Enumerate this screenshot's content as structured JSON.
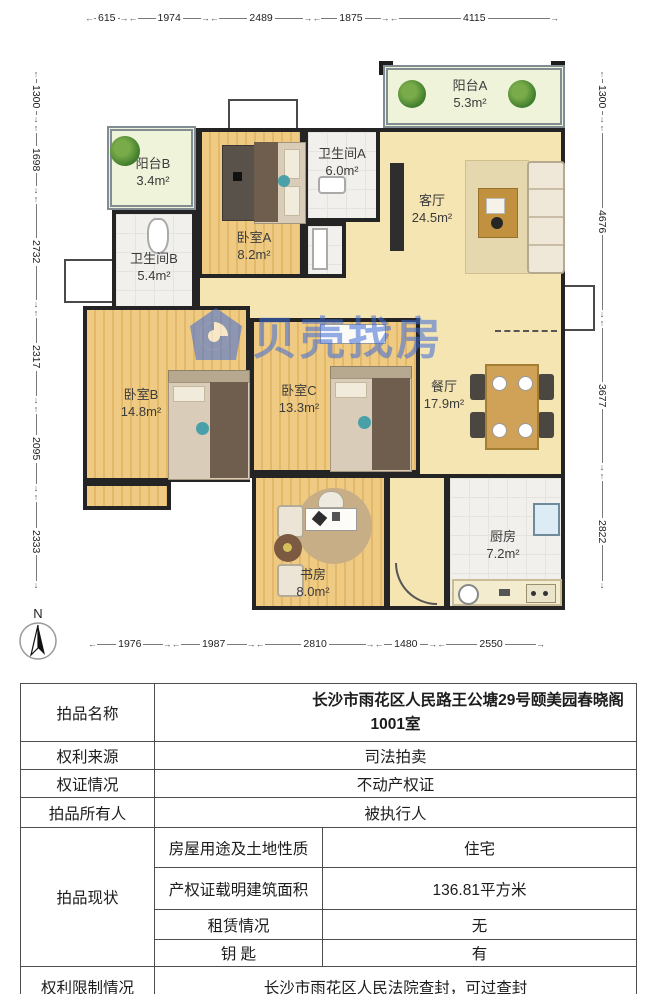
{
  "colors": {
    "accent_red": "#e8000d",
    "watermark_blue": "#3d6bd8",
    "wall": "#242424"
  },
  "floor_plan": {
    "watermark": "贝壳找房",
    "compass_label": "N",
    "dimensions": {
      "top": [
        615,
        1974,
        2489,
        1875,
        4115
      ],
      "bottom": [
        1976,
        1987,
        2810,
        1480,
        2550
      ],
      "left": [
        1300,
        1698,
        2732,
        2317,
        2095,
        2333
      ],
      "right": [
        1300,
        4676,
        3677,
        2822
      ]
    },
    "zones": [
      {
        "id": "main-floor",
        "type": "beige",
        "rect": [
          196,
          128,
          369,
          350
        ]
      },
      {
        "id": "entry-hall",
        "type": "beige",
        "rect": [
          386,
          474,
          62,
          136
        ]
      }
    ],
    "rooms": [
      {
        "id": "balcony-a",
        "name": "阳台A",
        "area": "5.3m²",
        "type": "balcony",
        "rect": [
          383,
          65,
          182,
          63
        ],
        "label": [
          470,
          95
        ]
      },
      {
        "id": "balcony-b",
        "name": "阳台B",
        "area": "3.4m²",
        "type": "balcony",
        "rect": [
          107,
          126,
          89,
          84
        ],
        "label": [
          153,
          173
        ]
      },
      {
        "id": "bedroom-a",
        "name": "卧室A",
        "area": "8.2m²",
        "type": "wood",
        "rect": [
          198,
          128,
          106,
          150
        ],
        "label": [
          254,
          247
        ]
      },
      {
        "id": "bath-a",
        "name": "卫生间A",
        "area": "6.0m²",
        "type": "tile",
        "rect": [
          304,
          128,
          76,
          94
        ],
        "label": [
          342,
          163
        ]
      },
      {
        "id": "bath-a-lower",
        "type": "tile",
        "rect": [
          304,
          222,
          42,
          56
        ]
      },
      {
        "id": "bath-b",
        "name": "卫生间B",
        "area": "5.4m²",
        "type": "tile",
        "rect": [
          112,
          210,
          84,
          122
        ],
        "label": [
          154,
          268
        ]
      },
      {
        "id": "bedroom-b",
        "name": "卧室B",
        "area": "14.8m²",
        "type": "wood",
        "rect": [
          83,
          306,
          167,
          176
        ],
        "label": [
          141,
          404
        ]
      },
      {
        "id": "bedroom-b-ext",
        "type": "wood",
        "rect": [
          83,
          482,
          88,
          28
        ]
      },
      {
        "id": "bedroom-c",
        "name": "卧室C",
        "area": "13.3m²",
        "type": "wood",
        "rect": [
          250,
          318,
          170,
          156
        ],
        "label": [
          299,
          400
        ]
      },
      {
        "id": "study",
        "name": "书房",
        "area": "8.0m²",
        "type": "wood",
        "rect": [
          252,
          474,
          136,
          136
        ],
        "label": [
          313,
          584
        ]
      },
      {
        "id": "kitchen",
        "name": "厨房",
        "area": "7.2m²",
        "type": "tile",
        "rect": [
          446,
          474,
          119,
          136
        ],
        "label": [
          503,
          546
        ]
      },
      {
        "id": "living",
        "name": "客厅",
        "area": "24.5m²",
        "label": [
          432,
          210
        ]
      },
      {
        "id": "dining",
        "name": "餐厅",
        "area": "17.9m²",
        "label": [
          444,
          396
        ]
      }
    ]
  },
  "table": {
    "auction_name": {
      "label": "拍品名称",
      "value": "长沙市雨花区人民路王公塘29号颐美园春晓阁1001室"
    },
    "rights_source": {
      "label": "权利来源",
      "value": "司法拍卖"
    },
    "cert_status": {
      "label": "权证情况",
      "value": "不动产权证"
    },
    "owner": {
      "label": "拍品所有人",
      "value": "被执行人"
    },
    "current_status": {
      "label": "拍品现状",
      "items": [
        {
          "label": "房屋用途及土地性质",
          "value": "住宅"
        },
        {
          "label": "产权证载明建筑面积",
          "value": "136.81平方米"
        },
        {
          "label": "租赁情况",
          "value": "无"
        },
        {
          "label": "钥 匙",
          "value": "有"
        }
      ]
    },
    "restriction": {
      "label": "权利限制情况",
      "value": "长沙市雨花区人民法院查封，可过查封"
    }
  }
}
